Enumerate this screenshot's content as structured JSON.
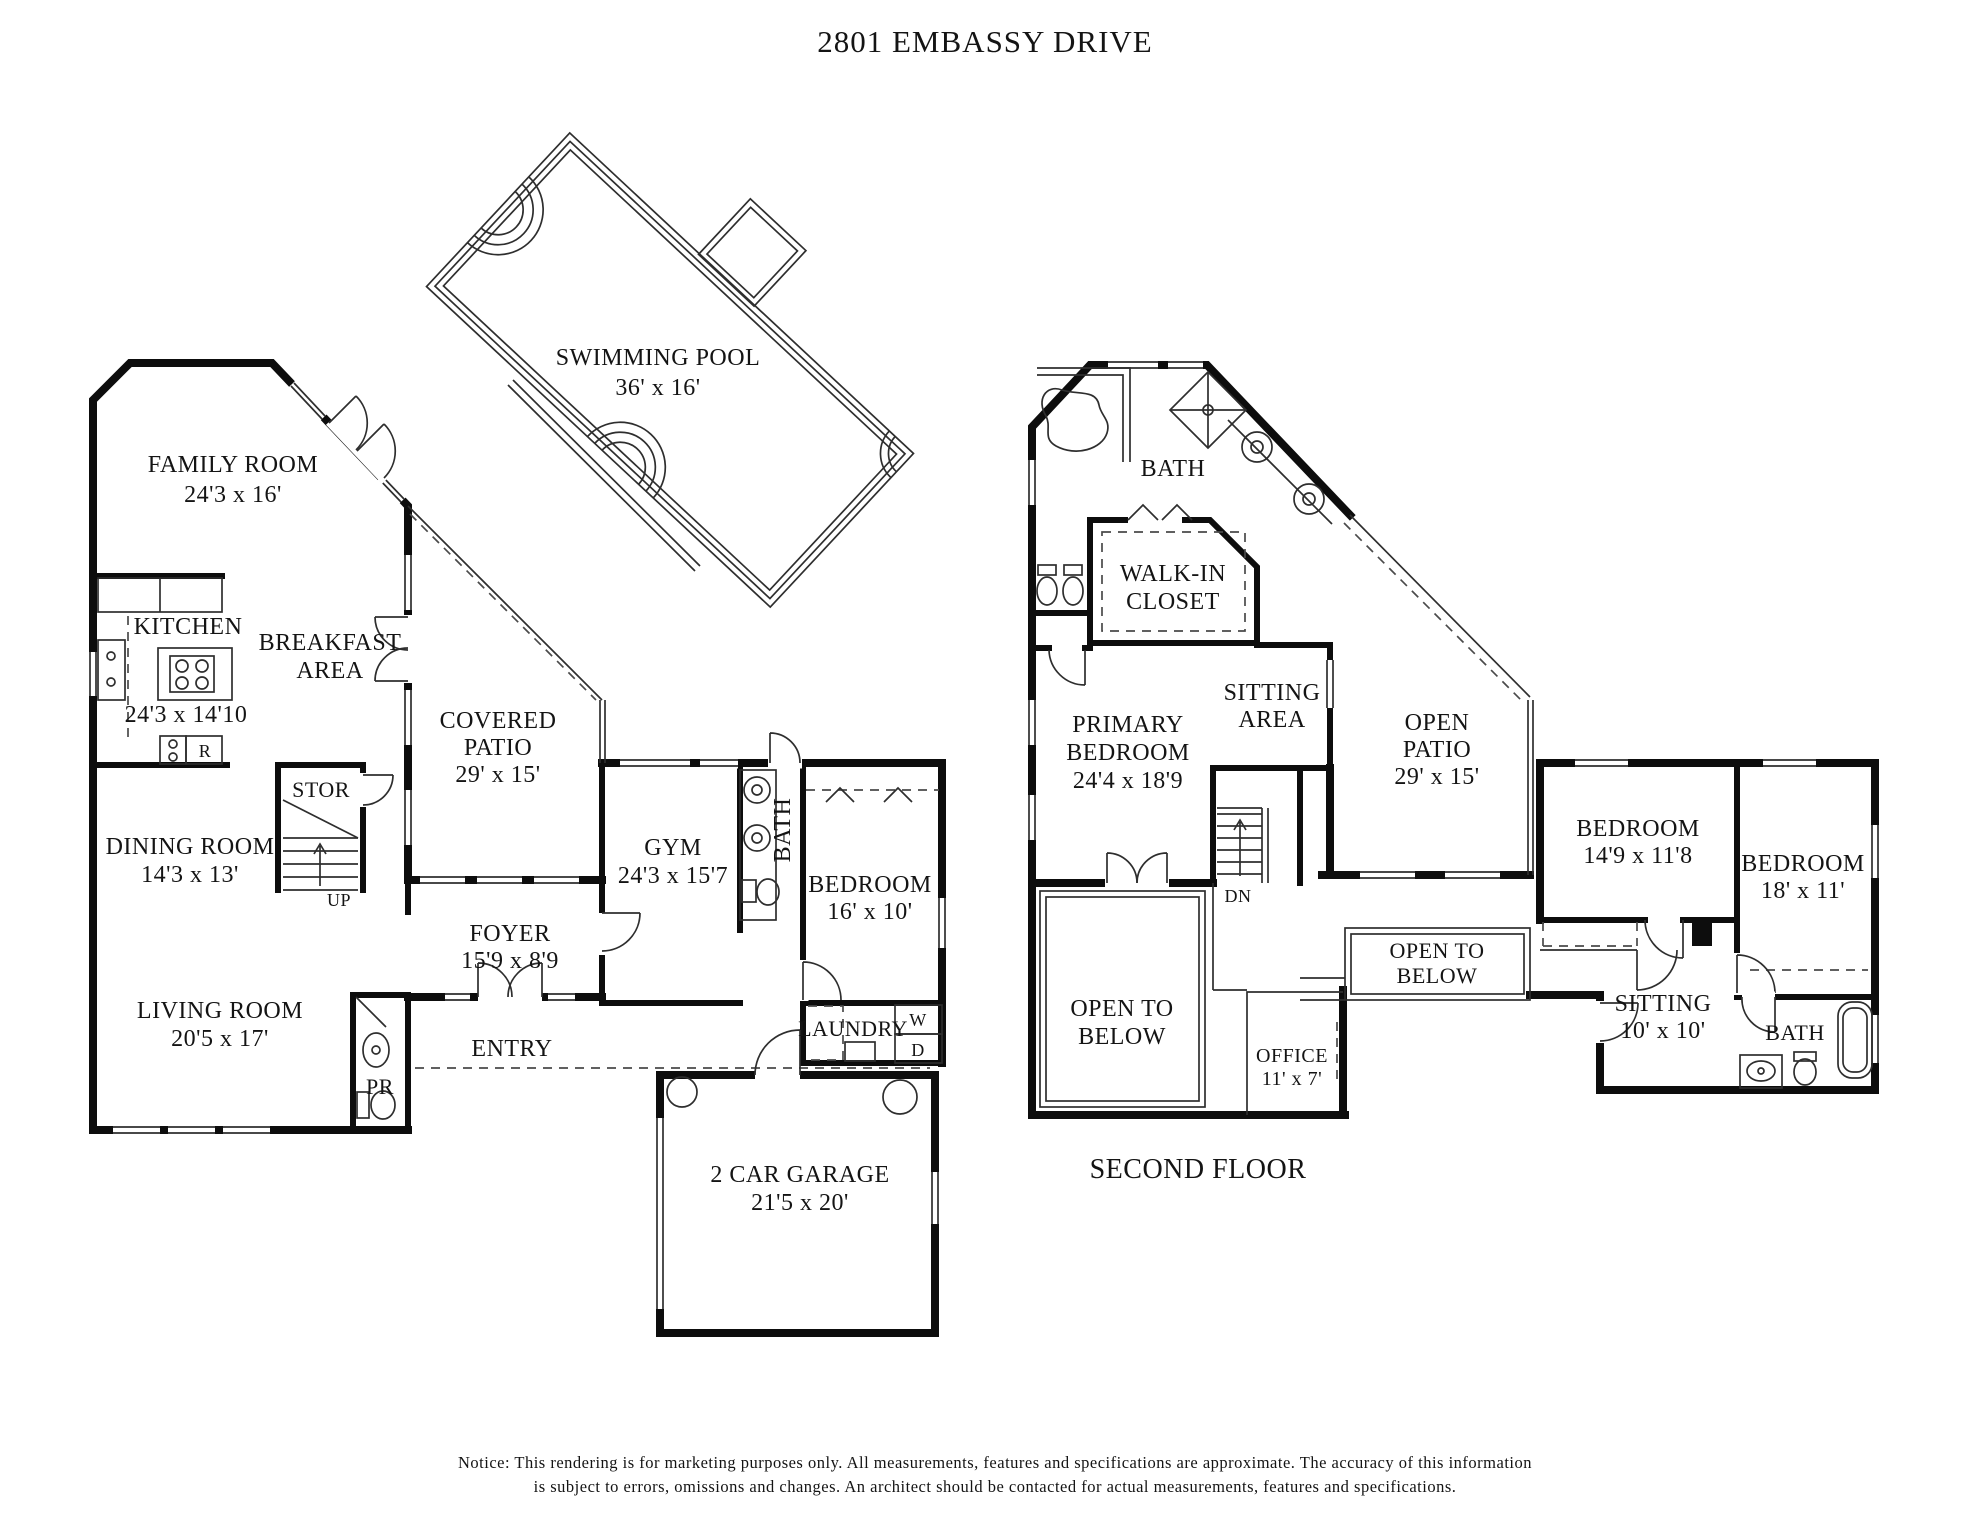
{
  "title": "2801 EMBASSY DRIVE",
  "pool": {
    "name": "SWIMMING POOL",
    "dims": "36' x 16'"
  },
  "first_floor": {
    "family_room": {
      "name": "FAMILY ROOM",
      "dims": "24'3 x 16'"
    },
    "kitchen": {
      "name": "KITCHEN",
      "dims": "24'3 x 14'10"
    },
    "breakfast": {
      "line1": "BREAKFAST",
      "line2": "AREA"
    },
    "covered_patio": {
      "line1": "COVERED",
      "line2": "PATIO",
      "dims": "29' x 15'"
    },
    "stor": {
      "name": "STOR"
    },
    "up_label": "UP",
    "fridge_label": "R",
    "dining": {
      "name": "DINING ROOM",
      "dims": "14'3 x 13'"
    },
    "gym": {
      "name": "GYM",
      "dims": "24'3 x 15'7"
    },
    "bath": {
      "name": "BATH"
    },
    "bedroom": {
      "name": "BEDROOM",
      "dims": "16' x 10'"
    },
    "foyer": {
      "name": "FOYER",
      "dims": "15'9 x 8'9"
    },
    "living": {
      "name": "LIVING ROOM",
      "dims": "20'5 x 17'"
    },
    "entry": {
      "name": "ENTRY"
    },
    "pr": {
      "name": "PR"
    },
    "laundry": {
      "name": "LAUNDRY",
      "washer": "W",
      "dryer": "D"
    },
    "garage": {
      "name": "2 CAR GARAGE",
      "dims": "21'5 x 20'"
    }
  },
  "second_floor": {
    "floor_label": "SECOND FLOOR",
    "bath": {
      "name": "BATH"
    },
    "walkin": {
      "line1": "WALK-IN",
      "line2": "CLOSET"
    },
    "primary": {
      "line1": "PRIMARY",
      "line2": "BEDROOM",
      "dims": "24'4 x 18'9"
    },
    "sitting_area": {
      "line1": "SITTING",
      "line2": "AREA"
    },
    "open_patio": {
      "line1": "OPEN",
      "line2": "PATIO",
      "dims": "29' x 15'"
    },
    "dn_label": "DN",
    "bedroom1": {
      "name": "BEDROOM",
      "dims": "14'9 x 11'8"
    },
    "bedroom2": {
      "name": "BEDROOM",
      "dims": "18' x 11'"
    },
    "open_below_left": {
      "line1": "OPEN TO",
      "line2": "BELOW"
    },
    "open_below_right": {
      "line1": "OPEN TO",
      "line2": "BELOW"
    },
    "office": {
      "name": "OFFICE",
      "dims": "11' x 7'"
    },
    "sitting": {
      "name": "SITTING",
      "dims": "10' x 10'"
    },
    "bath2": {
      "name": "BATH"
    }
  },
  "notice": {
    "line1": "Notice: This rendering is for marketing purposes only. All measurements, features and specifications are approximate. The accuracy of this information",
    "line2": "is subject to errors, omissions and changes. An architect should be contacted for actual measurements, features and specifications."
  }
}
